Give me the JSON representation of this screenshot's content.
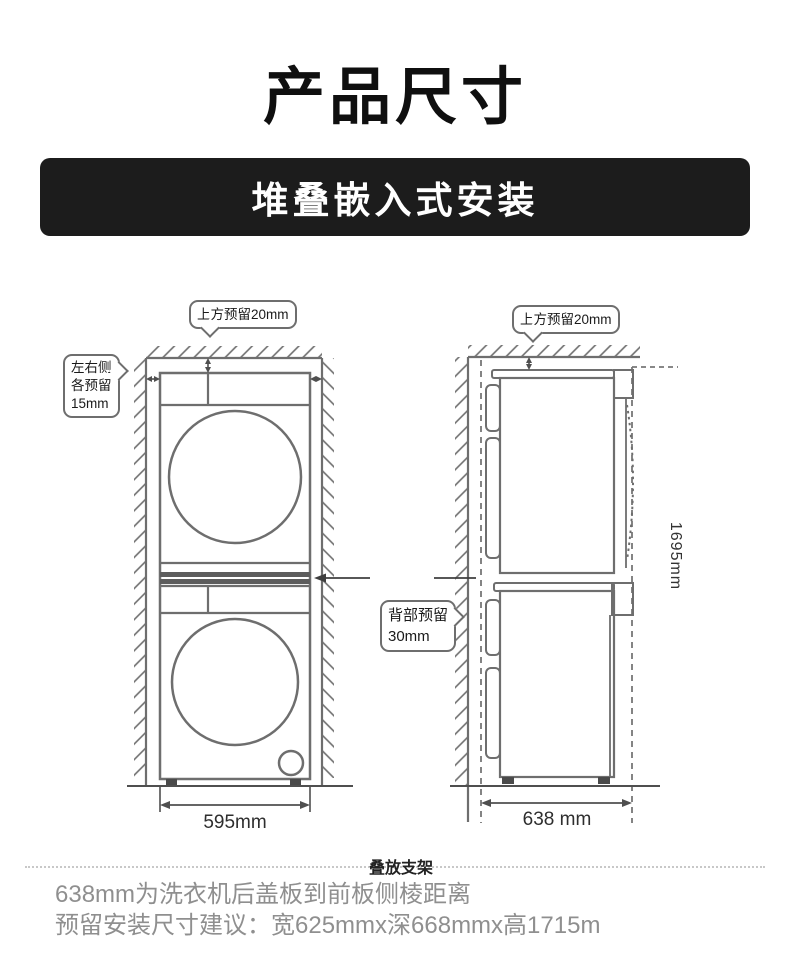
{
  "header": {
    "title": "产品尺寸",
    "banner": "堆叠嵌入式安装"
  },
  "front_view": {
    "top_clearance": "上方预留20mm",
    "side_clearance": [
      "左右侧",
      "各预留",
      "15mm"
    ],
    "width_label": "595mm"
  },
  "side_view": {
    "top_clearance": "上方预留20mm",
    "back_clearance": [
      "背部预留",
      "30mm"
    ],
    "height_label": "1695mm",
    "depth_label": "638 mm"
  },
  "bracket_label": "叠放支架",
  "footnotes": {
    "line1": "638mm为洗衣机后盖板到前板侧棱距离",
    "line2": "预留安装尺寸建议：宽625mmx深668mmx高1715m"
  },
  "colors": {
    "line": "#6e6e6e",
    "dim_line": "#4f4f4f",
    "banner_bg": "#1c1c1c",
    "footnote_text": "#8f8f8f"
  }
}
